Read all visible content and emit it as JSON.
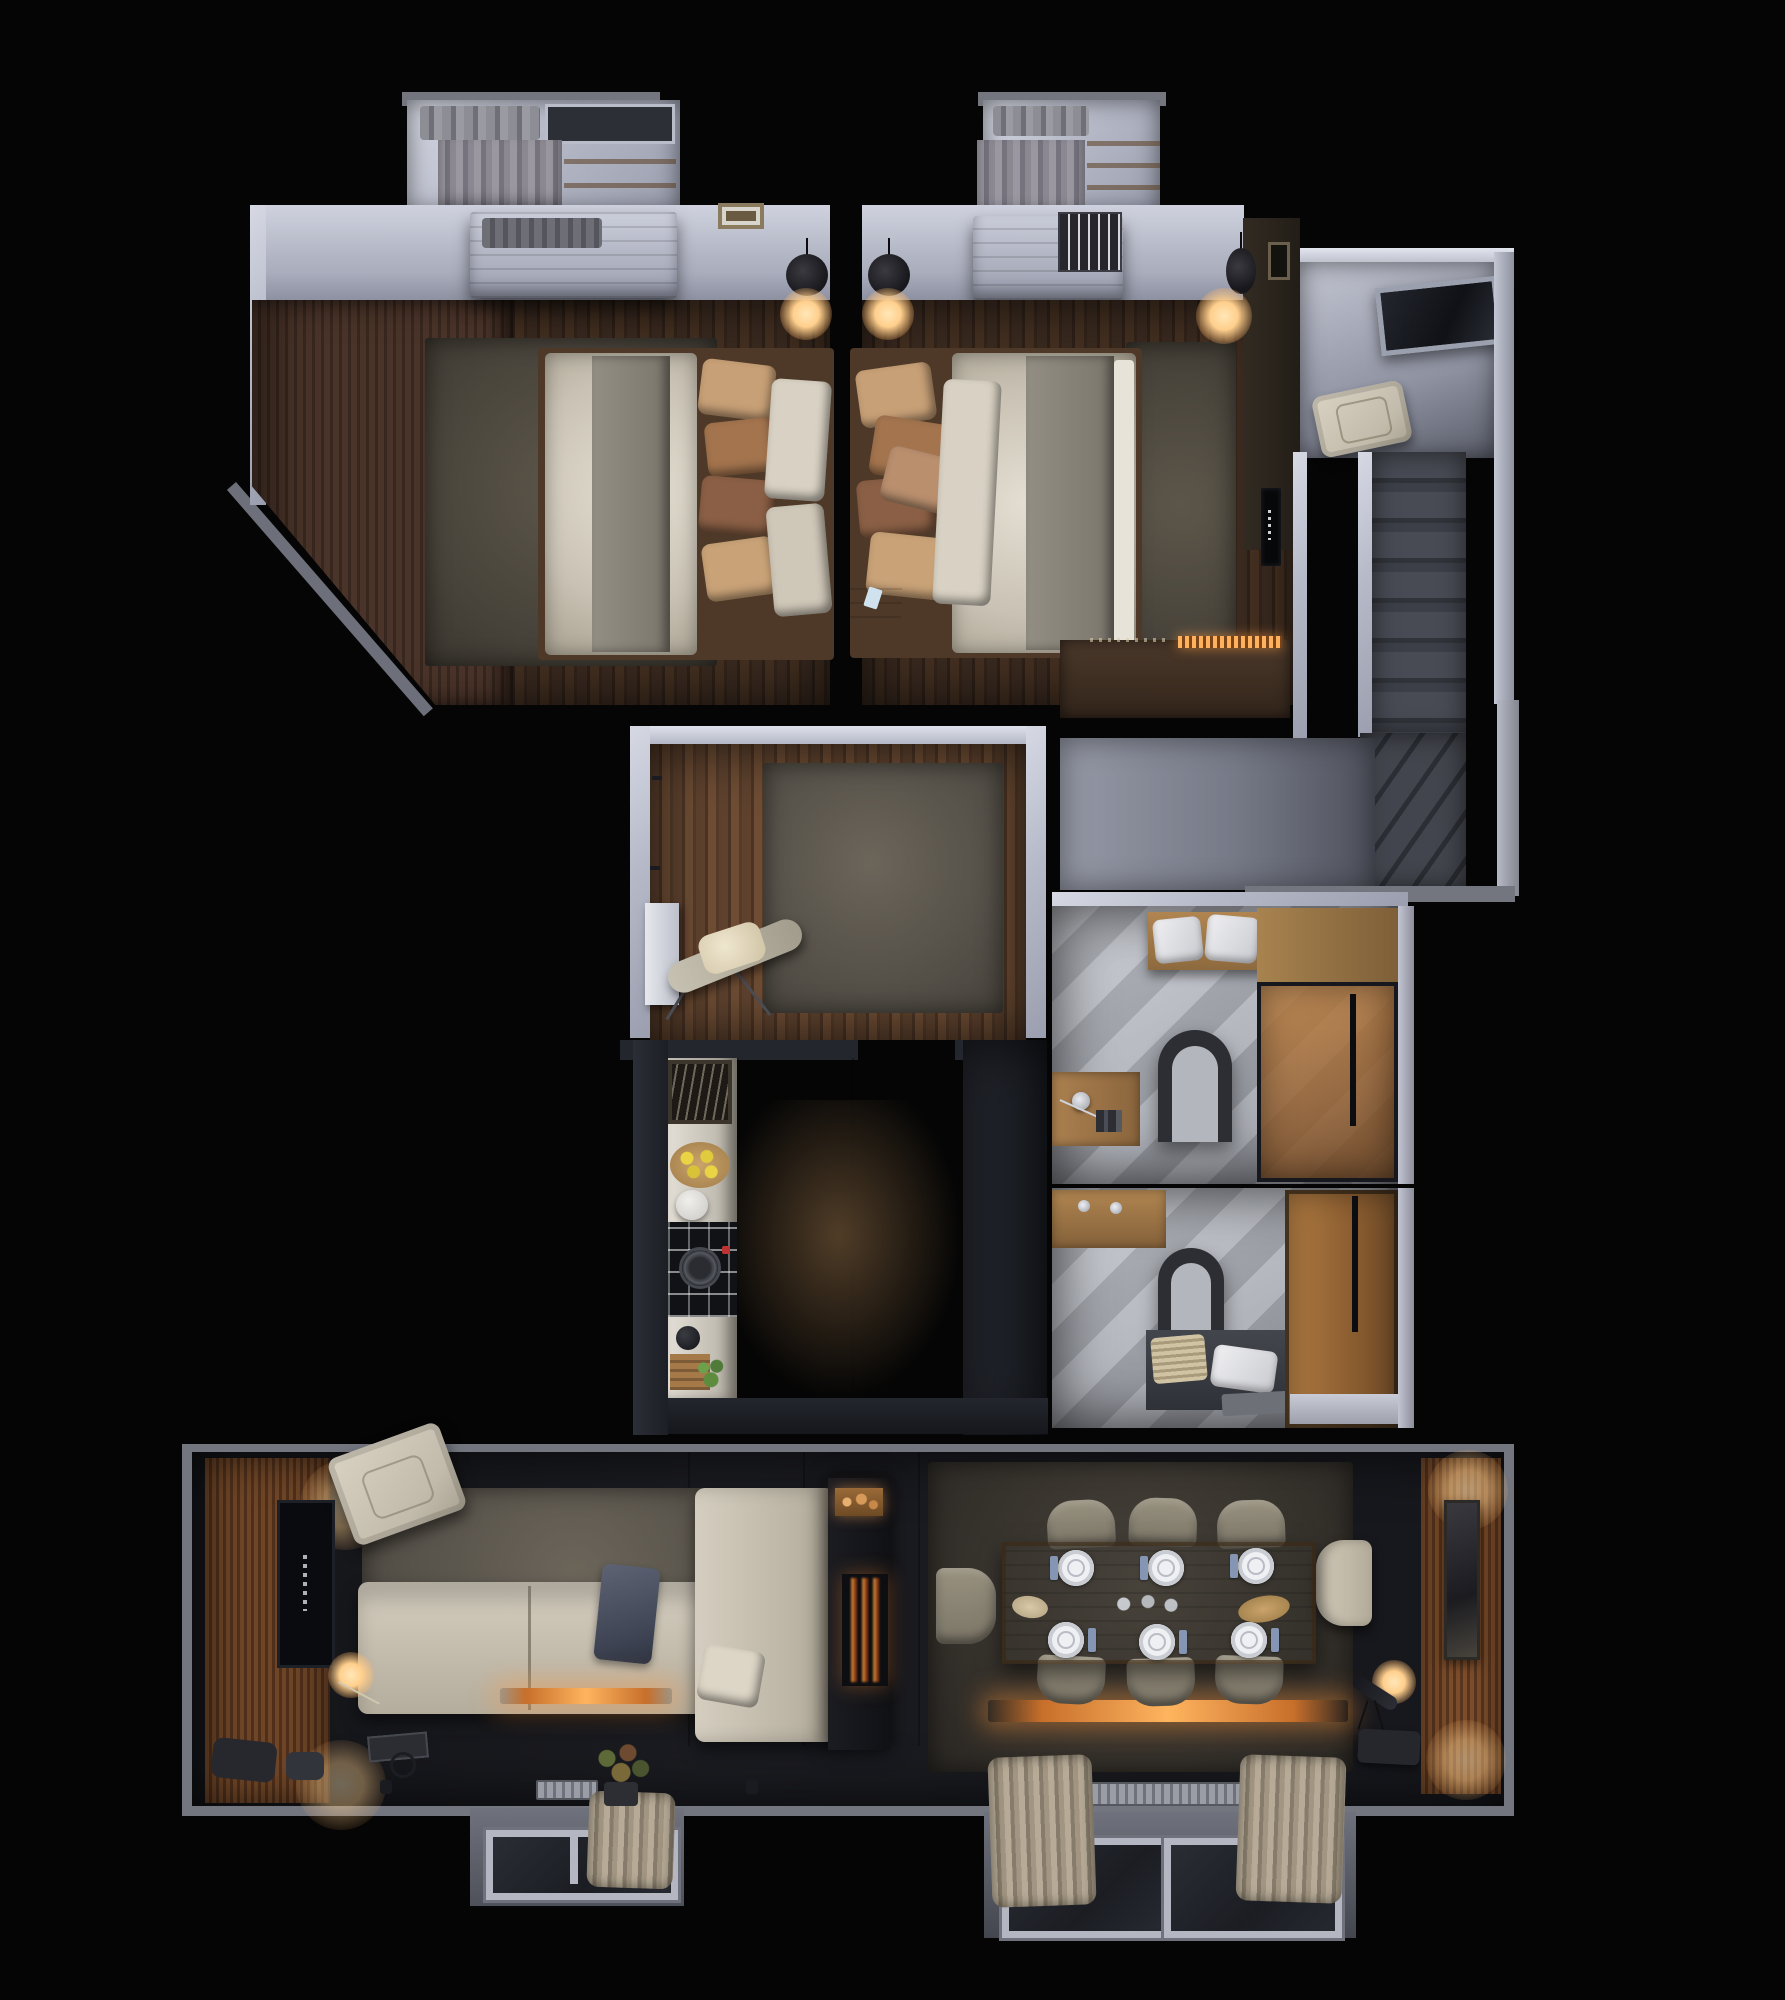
{
  "title": "3D floor plan render – one-storey apartment, top-down night view",
  "palette": {
    "bg": "#050505",
    "wall_white": "#c3c7d4",
    "wall_gray": "#73767f",
    "charcoal": "#23262d",
    "wood_dark": "#3a2a20",
    "wood_mid": "#5e422e",
    "wood_warm": "#9a6236",
    "rug_gray": "#57524a",
    "cream": "#d2cabb",
    "duvet": "#d9d3c7",
    "blanket": "#8b867c",
    "pillow_tan": "#b98f6e",
    "pillow_brown": "#8a5f45",
    "tile_light": "#c7cad1",
    "amber_glass": "#b5803f",
    "glow_warm": "#ffd9a0",
    "fire_orange": "#ff9c3f",
    "table_wood": "#b28a55",
    "napkin_blue": "#8596b4",
    "stair_tread": "#3c3f47",
    "curtain_beige": "#b7ab97"
  },
  "rooms": [
    {
      "name": "bedroom-1",
      "features": [
        "wardrobe",
        "closet with hanging clothes",
        "wood bench",
        "double bed",
        "rug",
        "pendant lamp",
        "wall frame"
      ]
    },
    {
      "name": "bedroom-2",
      "features": [
        "closet with hanging clothes",
        "wood bench",
        "double bed",
        "rug",
        "two pendant lamps",
        "tv accent wall",
        "dresser with lit strip",
        "nightstand"
      ]
    },
    {
      "name": "entry-hall",
      "features": [
        "glass entry door",
        "armchair",
        "staircase with winder turn"
      ]
    },
    {
      "name": "corridor",
      "features": [
        "stair landing"
      ]
    },
    {
      "name": "dressing-hall",
      "features": [
        "rug",
        "ironing board",
        "white console",
        "wall hooks"
      ]
    },
    {
      "name": "kitchen",
      "features": [
        "counter run",
        "art frame",
        "lemon board",
        "sink bowl",
        "induction cooktop with pan",
        "kettle",
        "plant crate",
        "tall dark cabinets"
      ]
    },
    {
      "name": "bathroom-1",
      "features": [
        "towel bench",
        "tub with arch filler",
        "shower shelf",
        "amber glass shower",
        "wood cabinet"
      ]
    },
    {
      "name": "bathroom-2",
      "features": [
        "wood vanity",
        "tub arch filler",
        "towel bench",
        "amber wardrobe cabinet"
      ]
    },
    {
      "name": "living-room",
      "features": [
        "slat tv wall",
        "armchair",
        "l-shaped sofa",
        "throw blanket",
        "floor lamp",
        "fireplace column with log niche",
        "lit hearth strip",
        "bay window with curtains",
        "plant"
      ]
    },
    {
      "name": "dining-room",
      "features": [
        "table with six place settings",
        "eight chairs",
        "floor lamp",
        "telescope",
        "lit hearth strip",
        "slat wall with art",
        "bay window with curtains",
        "radiator"
      ]
    }
  ],
  "counts": {
    "beds": 2,
    "pendant_lamps": 3,
    "dining_plates": 6,
    "dining_chairs": 8,
    "bathrooms": 2,
    "bay_windows": 2
  }
}
